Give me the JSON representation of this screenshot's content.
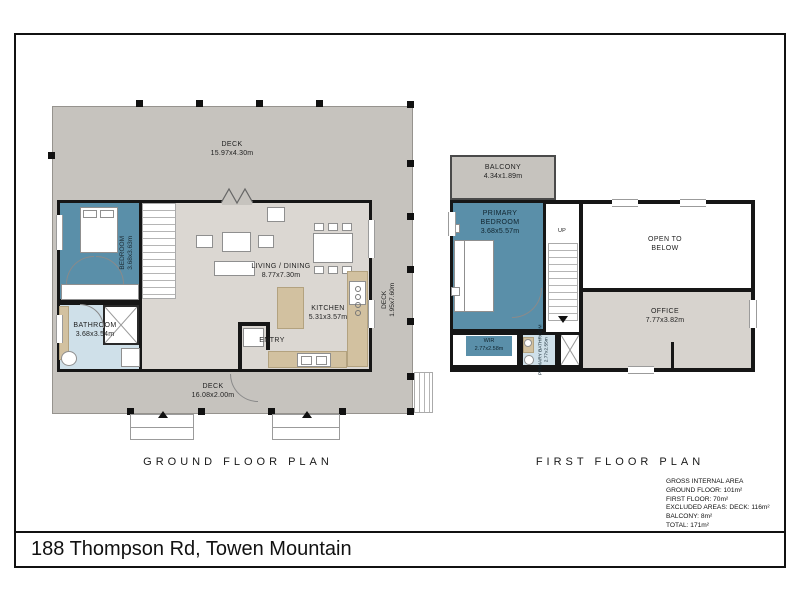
{
  "page": {
    "address": "188 Thompson Rd, Towen Mountain"
  },
  "colors": {
    "deck": "#c6c3be",
    "interior": "#dbd7d2",
    "office": "#d7d3ce",
    "bedroom": "#5a8fa9",
    "bathroom": "#cfe0e9",
    "counter": "#d2c1a0",
    "wall": "#161616",
    "thin": "#999999"
  },
  "ground_floor": {
    "title": "GROUND FLOOR PLAN",
    "rooms": {
      "deck_top": {
        "name": "DECK",
        "dims": "15.97x4.30m"
      },
      "deck_right": {
        "name": "DECK",
        "dims": "1.95x7.60m"
      },
      "deck_bottom": {
        "name": "DECK",
        "dims": "16.08x2.00m"
      },
      "bedroom": {
        "name": "BEDROOM",
        "dims": "3.68x3.63m"
      },
      "bathroom": {
        "name": "BATHROOM",
        "dims": "3.68x3.54m"
      },
      "living_dining": {
        "name": "LIVING / DINING",
        "dims": "8.77x7.30m"
      },
      "kitchen": {
        "name": "KITCHEN",
        "dims": "5.31x3.57m"
      },
      "entry": {
        "name": "ENTRY"
      }
    }
  },
  "first_floor": {
    "title": "FIRST FLOOR PLAN",
    "stairs_label": "UP",
    "rooms": {
      "balcony": {
        "name": "BALCONY",
        "dims": "4.34x1.89m"
      },
      "primary_bedroom": {
        "name": "PRIMARY BEDROOM",
        "dims": "3.68x5.57m"
      },
      "open_to_below": {
        "name": "OPEN TO BELOW"
      },
      "office": {
        "name": "OFFICE",
        "dims": "7.77x3.82m"
      },
      "wir": {
        "name": "WIR",
        "dims": "2.77x2.58m"
      },
      "primary_bathroom": {
        "name": "PRIMARY BATHROOM",
        "dims": "2.77x2.55m"
      }
    }
  },
  "area_summary": {
    "lines": [
      "GROSS INTERNAL AREA",
      "GROUND FLOOR: 101m²",
      "FIRST FLOOR: 70m²",
      "EXCLUDED AREAS: DECK: 116m²",
      "BALCONY: 8m²",
      "TOTAL: 171m²"
    ]
  }
}
